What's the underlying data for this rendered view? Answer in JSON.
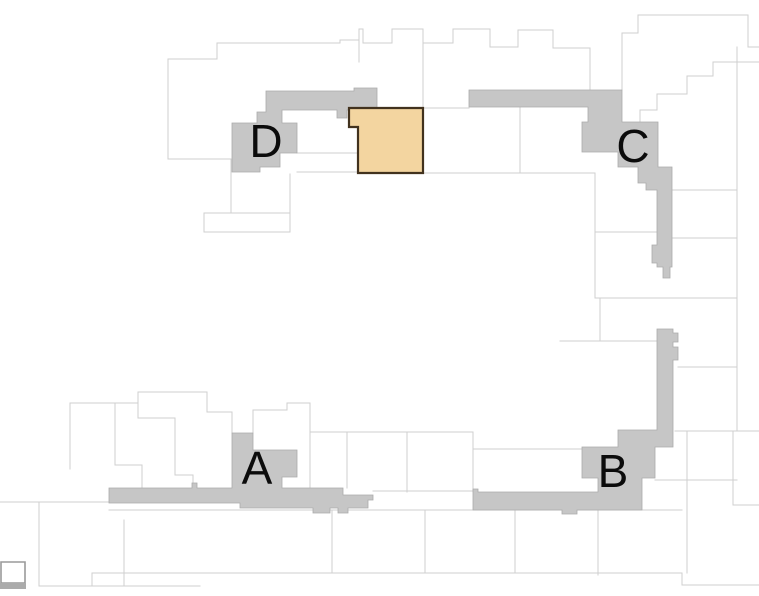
{
  "map": {
    "type": "parcel-plat-map",
    "background_color": "#ffffff",
    "parcel_line_color": "#cfcfcf",
    "zone_fill_color": "#c6c6c6",
    "zone_edge_color": "#ababab",
    "label_color": "#0b0b0b",
    "zones": [
      {
        "id": "zone-a",
        "label": "A"
      },
      {
        "id": "zone-b",
        "label": "B"
      },
      {
        "id": "zone-c",
        "label": "C"
      },
      {
        "id": "zone-d",
        "label": "D"
      }
    ],
    "highlight": {
      "name": "selected-parcel",
      "fill": "#f3d5a0",
      "stroke": "#42321e"
    },
    "corner_chip_fill": "#ababab"
  }
}
